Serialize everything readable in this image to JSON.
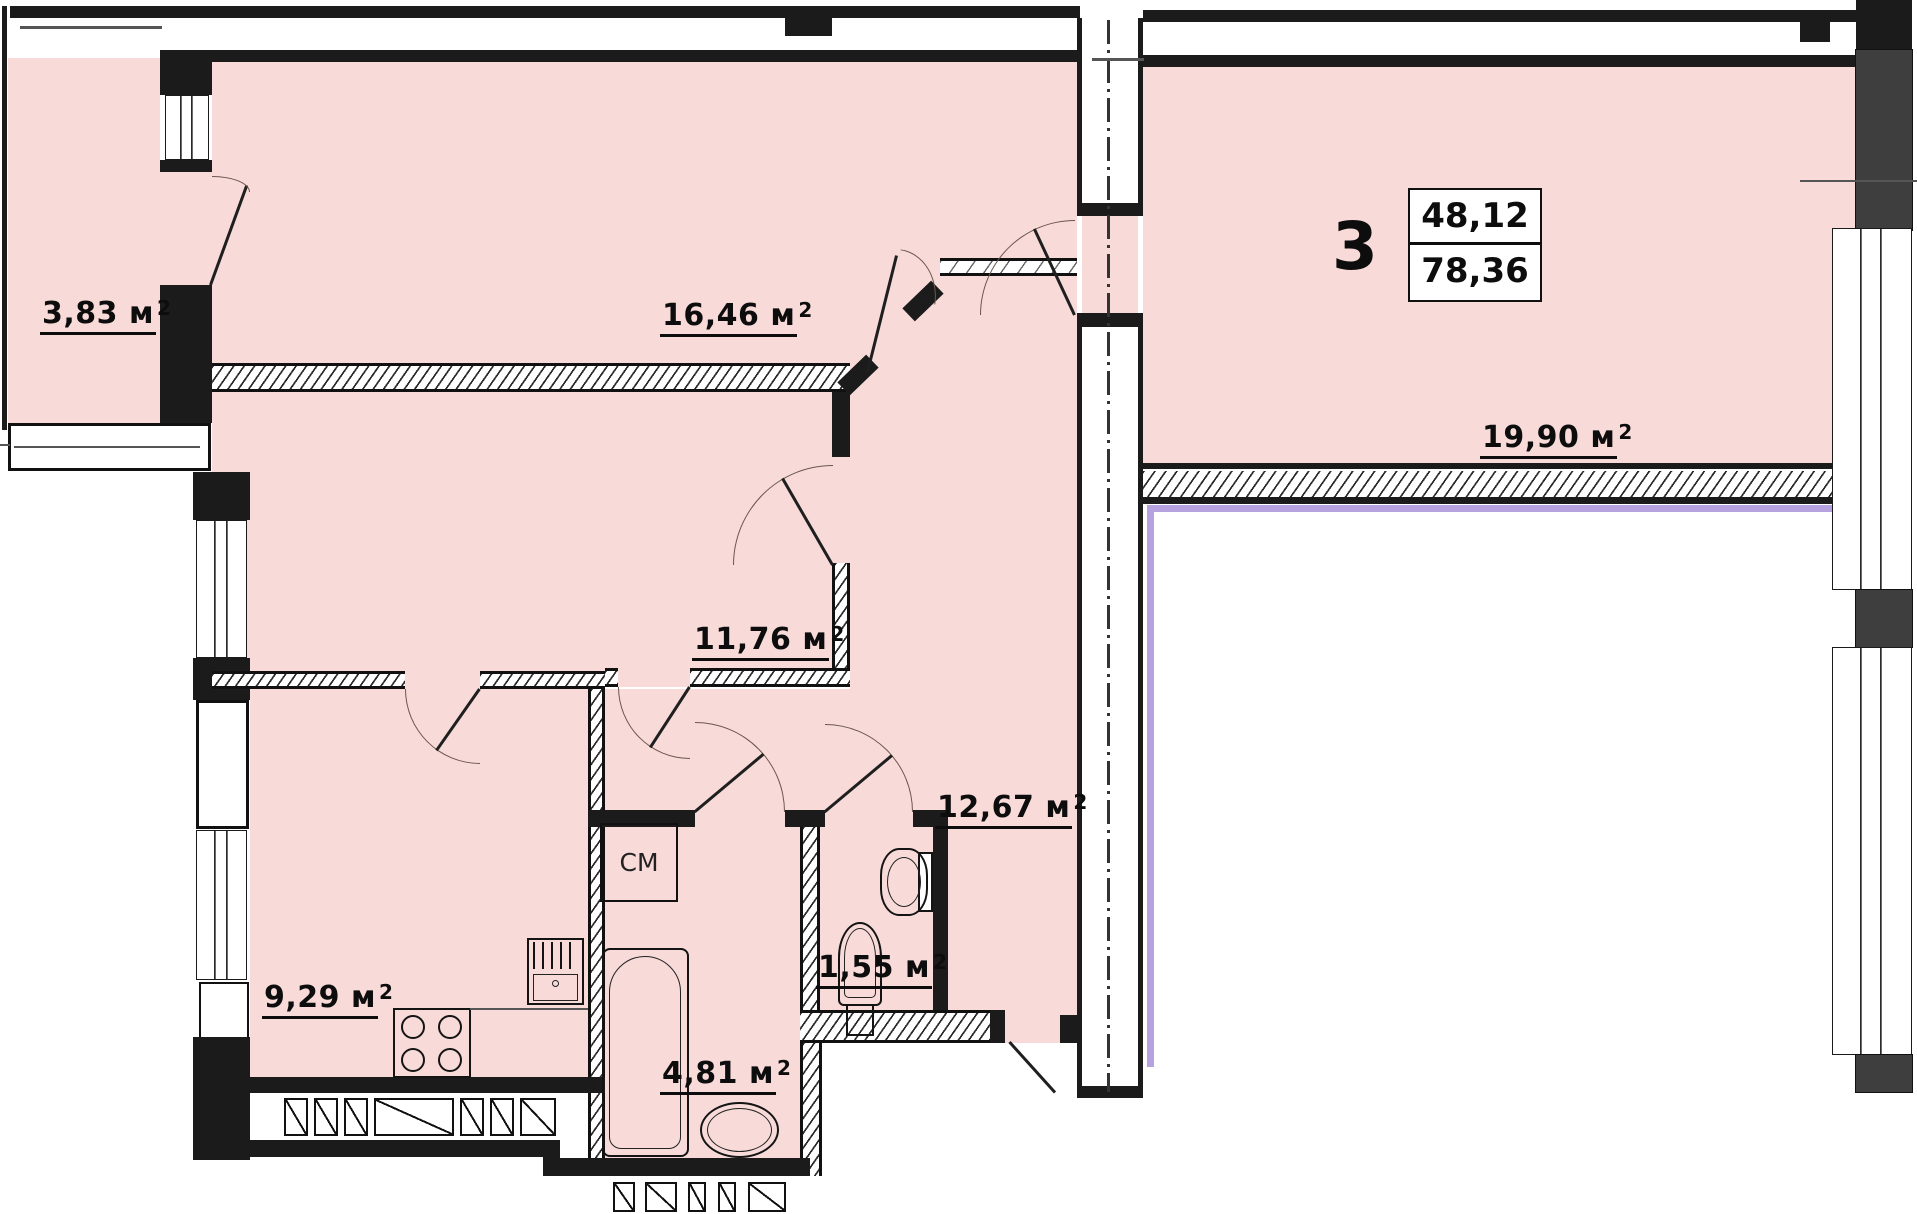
{
  "plan": {
    "apartment": {
      "number": "3",
      "upper_area": "48,12",
      "lower_area": "78,36"
    },
    "rooms": {
      "balcony": {
        "area": "3,83"
      },
      "living_room": {
        "area": "16,46"
      },
      "bedroom": {
        "area": "11,76"
      },
      "kitchen": {
        "area": "9,29"
      },
      "hallway": {
        "area": "12,67"
      },
      "wc": {
        "area": "1,55"
      },
      "bathroom": {
        "area": "4,81"
      },
      "room_right": {
        "area": "19,90"
      }
    },
    "labels": {
      "washing_machine": "СМ",
      "area_unit": "м",
      "area_sup": "2"
    },
    "colors": {
      "room_fill": "#f8dbd9",
      "wall": "#1b1b1b",
      "neighbor_outline": "#b5a2df",
      "arc": "#6b564c"
    }
  }
}
